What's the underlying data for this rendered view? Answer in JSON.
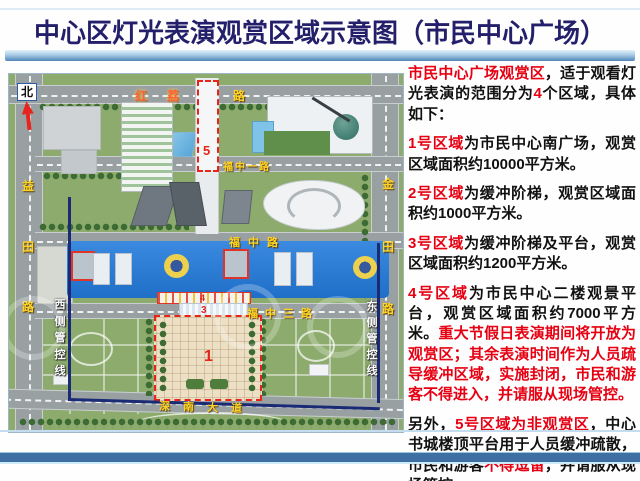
{
  "title": "中心区灯光表演观赏区域示意图（市民中心广场）",
  "map": {
    "north_label": "北",
    "roads": {
      "hongli_main": "红荔",
      "hongli_tail": "路",
      "fuzhongyi": "福中一路",
      "fuzhong": "福中路",
      "fuzhongsan": "福中三路",
      "shennan": "深南大道",
      "yitian": "益田路",
      "jintian": "金田路"
    },
    "control_lines": {
      "west": "西侧管控线",
      "east": "东侧管控线"
    },
    "zones": {
      "z1": "1",
      "z2": "2",
      "z3": "3",
      "z4": "4",
      "z5": "5"
    }
  },
  "panel": {
    "paragraphs": [
      {
        "segments": [
          {
            "text": "市民中心广场观赏区",
            "style": "red"
          },
          {
            "text": "，适于观看灯光表演的范围分为",
            "style": "black"
          },
          {
            "text": "4",
            "style": "red"
          },
          {
            "text": "个区域，具体如下：",
            "style": "black"
          }
        ]
      },
      {
        "segments": [
          {
            "text": "1号区域",
            "style": "red"
          },
          {
            "text": "为市民中心南广场，观赏区域面积约10000平方米。",
            "style": "black"
          }
        ]
      },
      {
        "segments": [
          {
            "text": "2号区域",
            "style": "red"
          },
          {
            "text": "为缓冲阶梯，观赏区域面积约1000平方米。",
            "style": "black"
          }
        ]
      },
      {
        "segments": [
          {
            "text": "3号区域",
            "style": "red"
          },
          {
            "text": "为缓冲阶梯及平台，观赏区域面积约1200平方米。",
            "style": "black"
          }
        ]
      },
      {
        "segments": [
          {
            "text": "4号区域",
            "style": "red"
          },
          {
            "text": "为市民中心二楼观景平台，观赏区域面积约7000平方米。",
            "style": "black"
          },
          {
            "text": "重大节假日表演期间将开放为观赏区；其余表演时间作为人员疏导缓冲区域，实施封闭，市民和游客不得进入，并请服从现场管控。",
            "style": "red"
          }
        ]
      },
      {
        "segments": [
          {
            "text": "另外，",
            "style": "black"
          },
          {
            "text": "5号区域为非观赏区",
            "style": "red"
          },
          {
            "text": "，中心书城楼顶平台用于人员缓冲疏散，市民和游客",
            "style": "black"
          },
          {
            "text": "不得逗留",
            "style": "red"
          },
          {
            "text": "，并请服从现场管控。",
            "style": "black"
          }
        ]
      }
    ]
  },
  "colors": {
    "title_navy": "#241f6b",
    "highlight_red": "#e60012",
    "body_black": "#111111",
    "roof_blue": "#2b7fd6",
    "boundary_navy": "#1b2a75",
    "zone_border_red": "#e8241a",
    "road_label_yellow": "#ffd321",
    "divider_blue": "#3e6fa2"
  }
}
